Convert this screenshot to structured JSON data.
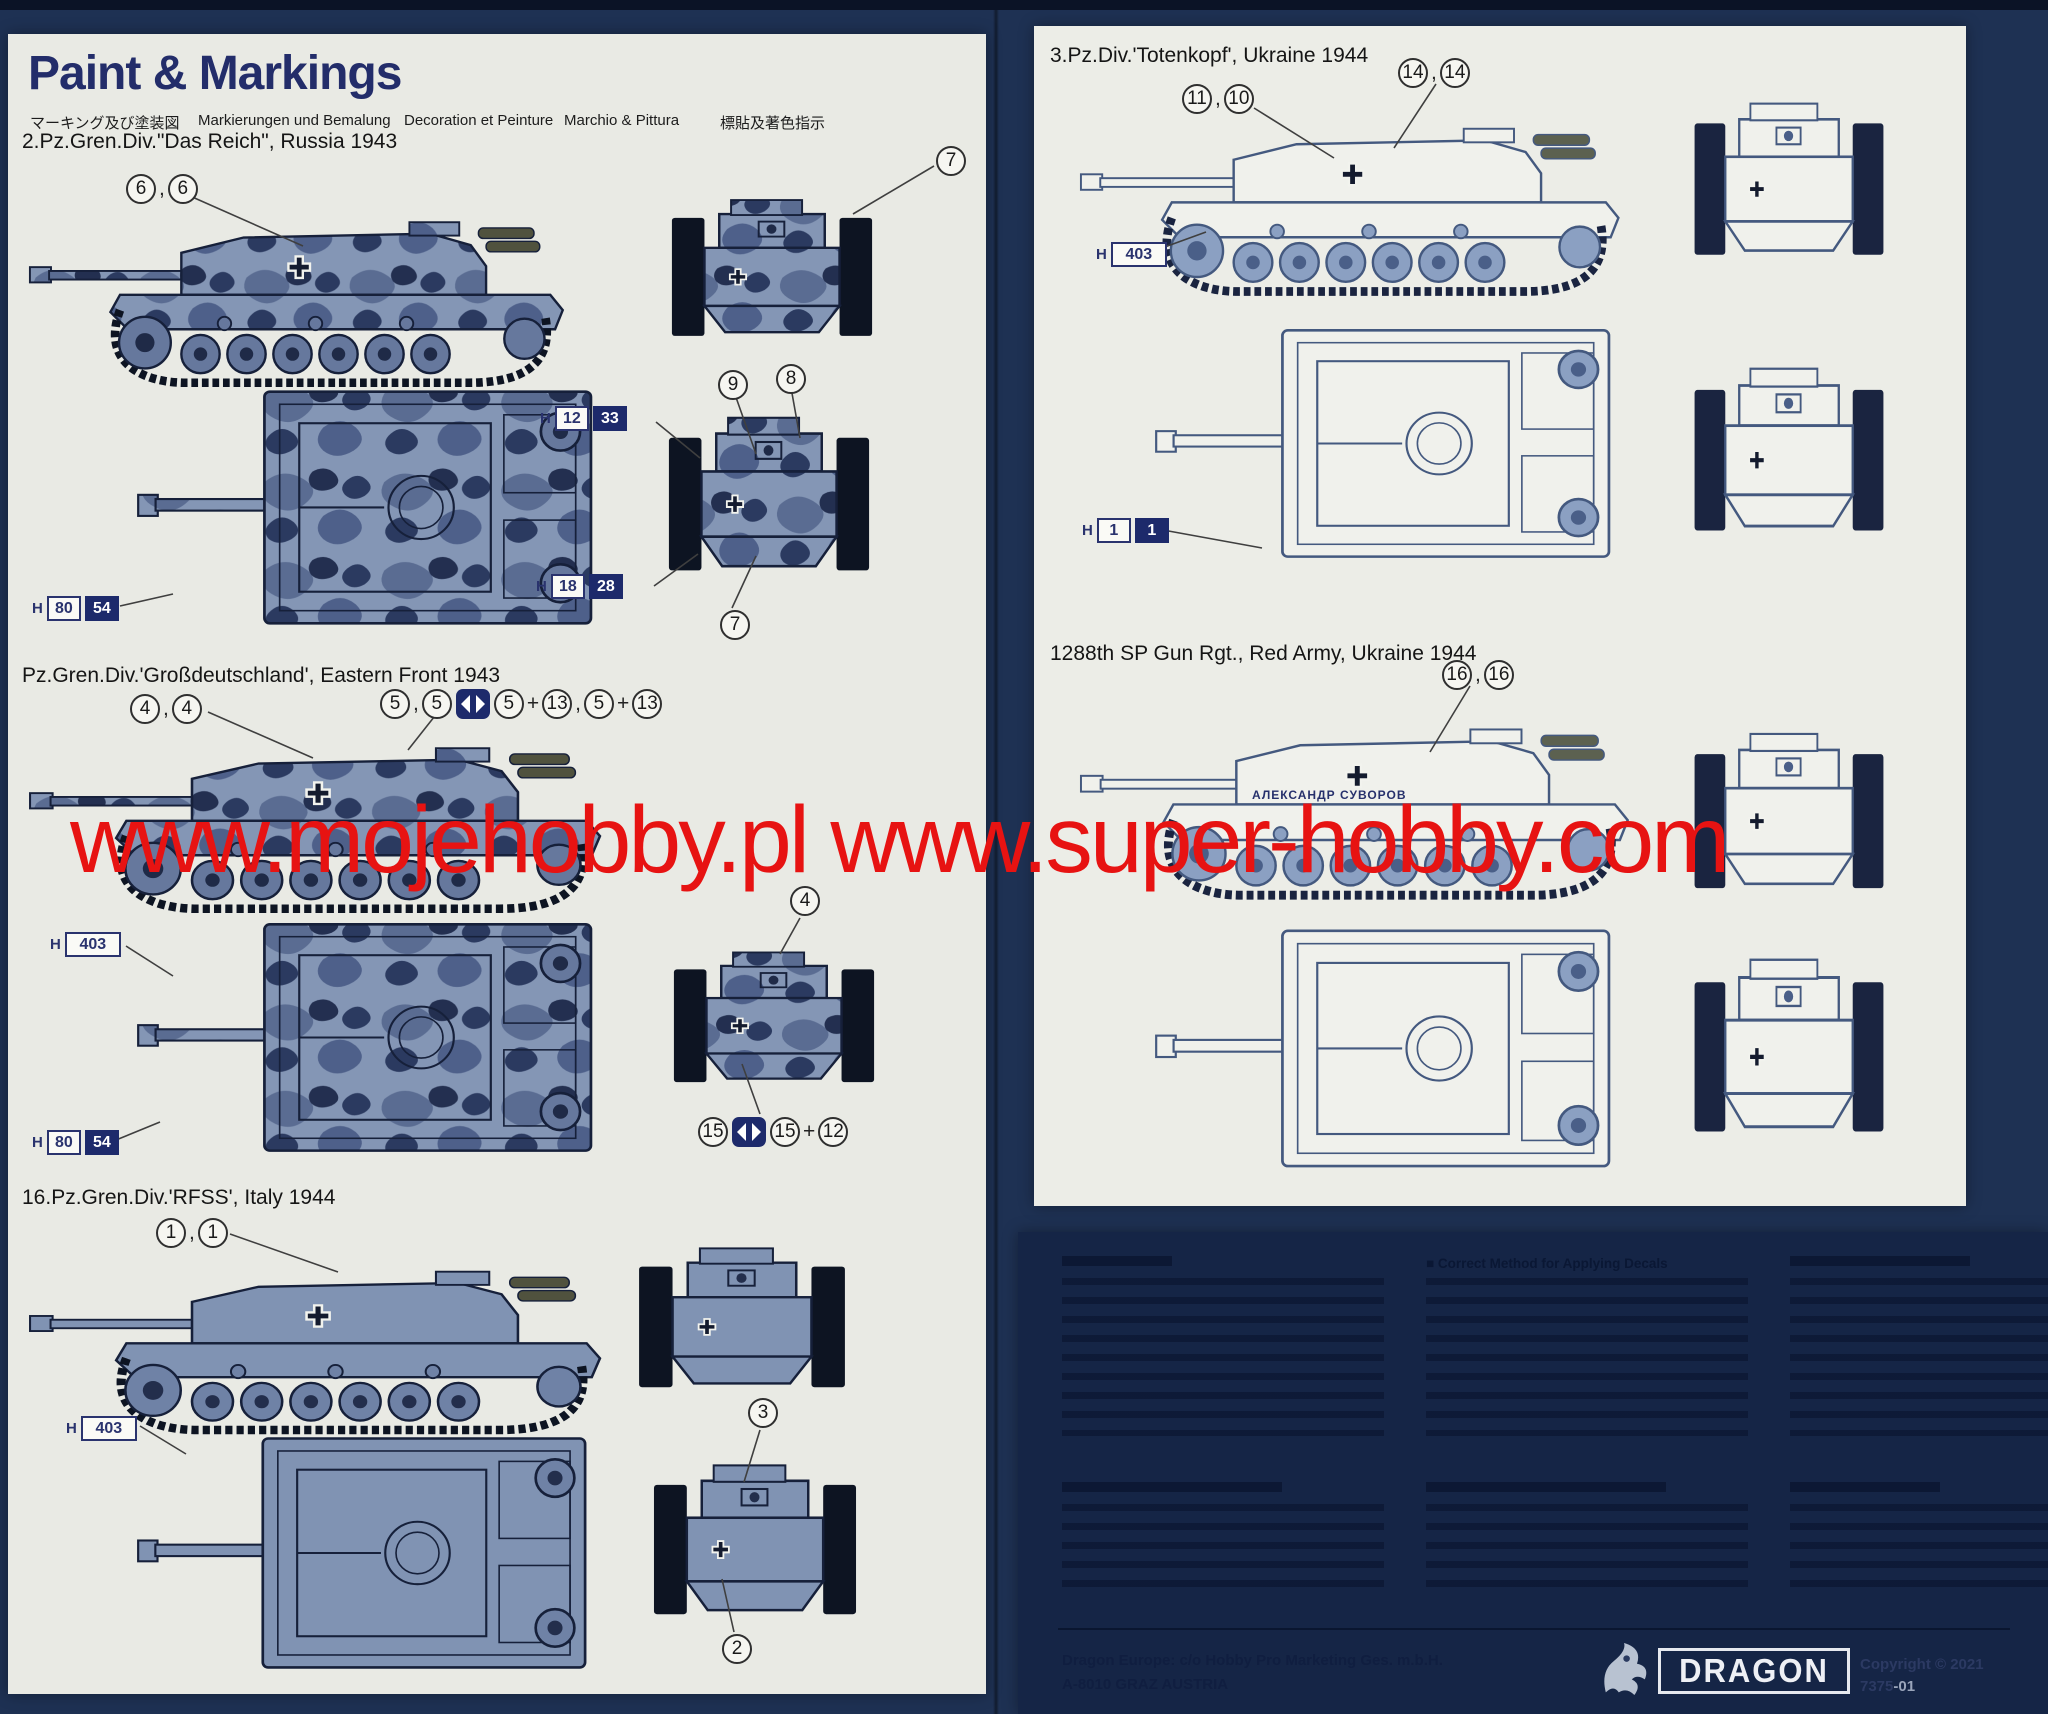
{
  "watermark": "www.mojehobby.pl www.super-hobby.com",
  "symbols": {
    "comma": ",",
    "plus": "+"
  },
  "left": {
    "title": "Paint & Markings",
    "sub_ja": "マーキング及び塗装図",
    "sub_de": "Markierungen und Bemalung",
    "sub_fr": "Decoration et Peinture",
    "sub_it": "Marchio & Pittura",
    "sub_zh": "標貼及著色指示",
    "das_reich": {
      "heading": "2.Pz.Gren.Div.\"Das Reich\", Russia 1943",
      "co_top": [
        "6",
        "6"
      ],
      "co_front": "7",
      "co_rear_a": "9",
      "co_rear_b": "8",
      "co_rear_c": "7",
      "chip_top": {
        "p": "H",
        "a": "80",
        "b": "54"
      },
      "chip_rear1": {
        "p": "H",
        "a": "12",
        "b": "33"
      },
      "chip_rear2": {
        "p": "H",
        "a": "18",
        "b": "28"
      }
    },
    "gross": {
      "heading": "Pz.Gren.Div.'Großdeutschland', Eastern Front 1943",
      "co_left": [
        "4",
        "4"
      ],
      "row5": [
        "5",
        "5",
        "5",
        "13",
        "5",
        "13"
      ],
      "chip_403": {
        "p": "H",
        "a": "403"
      },
      "chip_8054": {
        "p": "H",
        "a": "80",
        "b": "54"
      },
      "co_front": "4",
      "row15": [
        "15",
        "15",
        "12"
      ]
    },
    "rfss": {
      "heading": "16.Pz.Gren.Div.'RFSS', Italy 1944",
      "co_top": [
        "1",
        "1"
      ],
      "chip_403": {
        "p": "H",
        "a": "403"
      },
      "co_rear_top": "3",
      "co_rear_bottom": "2"
    }
  },
  "right": {
    "totenkopf": {
      "heading": "3.Pz.Div.'Totenkopf', Ukraine 1944",
      "co_a": [
        "11",
        "10"
      ],
      "co_b": [
        "14",
        "14"
      ],
      "chip_403": {
        "p": "H",
        "a": "403"
      },
      "chip_11": {
        "p": "H",
        "a": "1",
        "b": "1"
      }
    },
    "red_army": {
      "heading": "1288th SP Gun Rgt., Red Army, Ukraine 1944",
      "co": [
        "16",
        "16"
      ],
      "tank_name": "АЛЕКСАНДР СУВОРОВ"
    }
  },
  "instructions": {
    "heading_en": "Correct Method for Applying Decals",
    "footer_line1": "Dragon Europe: c/o Hobby Pro Marketing Ges. m.b.H.",
    "footer_line2": "A-8010 GRAZ AUSTRIA",
    "brand": "DRAGON",
    "copyright": "Copyright © 2021",
    "item_no": "7375",
    "item_suffix": "-01"
  }
}
